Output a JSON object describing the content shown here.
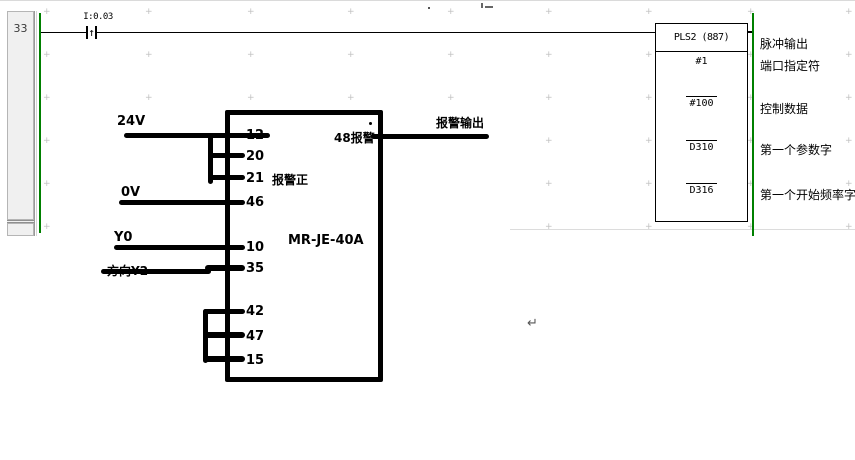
{
  "colors": {
    "rail_green": "#008000",
    "wire_black": "#000000",
    "grid_mark": "#c2c2c2"
  },
  "ladder": {
    "rung_number": "33",
    "contact_label": "I:0.03",
    "contact_symbol": "↑",
    "block_title": "PLS2 (887)",
    "operands": [
      "#1",
      "#100",
      "D310",
      "D316"
    ],
    "descriptions": [
      "脉冲输出",
      "端口指定符",
      "控制数据",
      "第一个参数字",
      "第一个开始频率字"
    ]
  },
  "diagram": {
    "device": "MR-JE-40A",
    "pins": [
      "12",
      "20",
      "21",
      "46",
      "10",
      "35",
      "42",
      "47",
      "15"
    ],
    "label_24v": "24V",
    "label_0v": "0V",
    "label_y0": "Y0",
    "label_direction": "方向Y2",
    "label_alarm_positive": "报警正",
    "label_alarm_48": "48报警",
    "label_alarm_output": "报警输出"
  },
  "misc": {
    "return_mark": "↵"
  }
}
